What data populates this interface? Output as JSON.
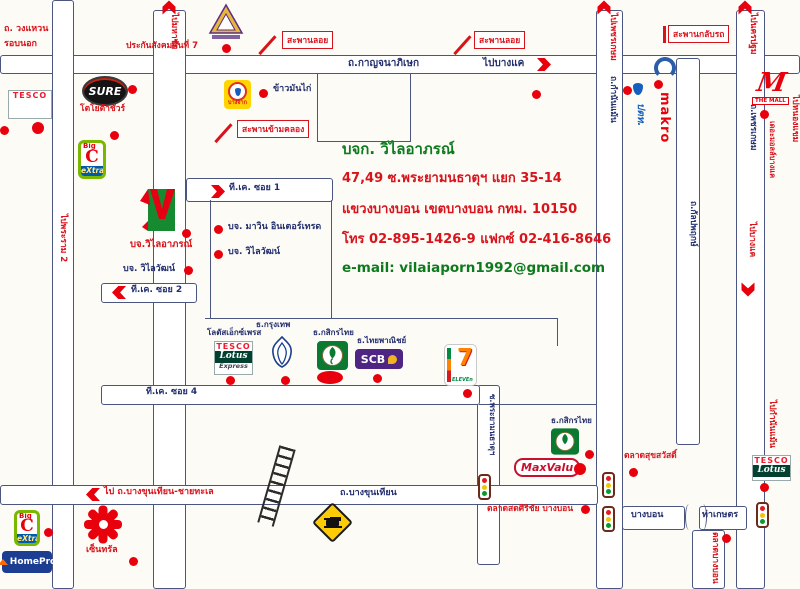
{
  "colors": {
    "accent_red": "#d8131b",
    "marker_red": "#e8000d",
    "road_line_navy": "#4a5580",
    "text_navy": "#232f6e",
    "text_green": "#0e7a1e"
  },
  "company": {
    "title": "บจก. วิไลอาภรณ์",
    "address_line1": "47,49 ซ.พระยามนธาตุฯ แยก 35-14",
    "address_line2": "แขวงบางบอน เขตบางบอน กทม. 10150",
    "phone_line": "โทร 02-895-1426-9 แฟกซ์ 02-416-8646",
    "email_line": "e-mail: vilaiaporn1992@gmail.com"
  },
  "labels": {
    "ring_road_line1": "ถ. วงแหวน",
    "ring_road_line2": "รอบนอก",
    "sso": "ประกันสังคมพื้นที่ 7",
    "overpass": "สะพานลอย",
    "kanchanaphisek_rd": "ถ.กาญจนาภิเษก",
    "to_bangkhae": "ไปบางแค",
    "uturn_bridge": "สะพานกลับรถ",
    "canal_bridge": "สะพานข้ามคลอง",
    "chicken_rice": "ข้าวมันไก่",
    "toyota_sure": "โตโยต้าชัวร์",
    "to_mahachai": "ไปมหาชัย",
    "to_rama2": "ไปพระราม 2",
    "to_phetkasem": "ไปเพชรเกษม",
    "kamnan_maen_rd": "ถ.กำนันแม้น",
    "to_nakhon_pathom": "ไปนครปฐม",
    "phetkasem_rd": "ถ.เพชรเกษม",
    "kalpapruek_rd": "ถ.กัลปพฤกษ์",
    "the_mall_bangkhae": "เดอะมอลล์บางแค",
    "to_nong_khaem": "ไปหนองแขม",
    "tk_soi1": "ที.เค. ซอย 1",
    "tk_soi2": "ที.เค. ซอย 2",
    "tk_soi4": "ที.เค. ซอย 4",
    "mawin_intertrade": "บจ. มาวิน อินเตอร์เทรด",
    "wilaiwat": "บจ. วิไลวัฒน์",
    "vilaiaporn_sign": "บจ.วิไลอาภรณ์",
    "lotus_express": "โลตัสเอ็กซ์เพรส",
    "bangkok_bank": "ธ.กรุงเทพ",
    "kasikorn_bank": "ธ.กสิกรไทย",
    "scb_bank": "ธ.ไทยพาณิชย์",
    "praya_monthat_soi": "ซ.พระยามนธาตุฯ",
    "bangkhunthian_rd": "ถ.บางขุนเทียน",
    "to_bangkhunthian_sea": "ไป ถ.บางขุนเทียน-ชายทะเล",
    "sirichai_market": "ตลาดสดศิริชัย บางบอน",
    "suksawat_market": "ตลาดสุขสวัสดิ์",
    "bangbon_segment": "บางบอน",
    "tha_kaset_segment": "ท่าเกษตร",
    "bangbon_market": "ตลาดบางบอน",
    "to_kamnan_maen": "ไปกำนันแม้น",
    "central": "เซ็นทรัล"
  },
  "logos": {
    "tesco": "TESCO",
    "lotus": "Lotus",
    "express": "Express",
    "sure": "SURE",
    "bangchak": "บางจาก",
    "bigc_big": "Big",
    "bigc_c": "C",
    "bigc_extra": "eXtra",
    "makro": "makro",
    "ptt": "ปตท.",
    "the_mall_m": "M",
    "the_mall": "THE MALL",
    "scb": "SCB",
    "seven": "7",
    "seven_eleven": "ELEVEn",
    "maxvalu": "MaxValu",
    "homepro": "HomePro"
  }
}
